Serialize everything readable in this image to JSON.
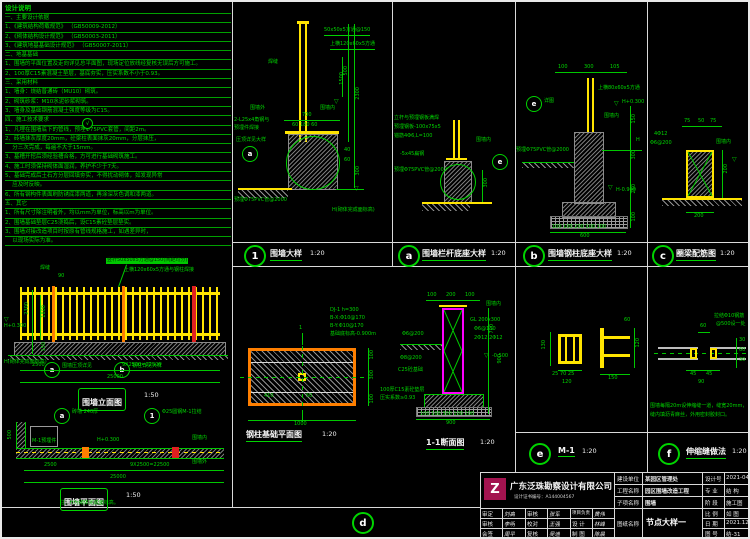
{
  "notes": {
    "title": "设计说明",
    "badge": "√",
    "lines": [
      "一、主要设计依据",
      "1、《建筑结构荷载规范》 （GB50009-2012）",
      "2、《砌体结构设计规范》 （GB50003-2011）",
      "3、《建筑地基基础设计规范》 （GB50007-2011）",
      "二、地基基础",
      "1、围墙的平面位置及走向详见总平面图，现场定位放线经复核无误后方可施工。",
      "2、100厚C15素混凝土垫层，基底夯实，压实系数不小于0.93。",
      "三、采用材料",
      "1、墙身：烧结普通砖（MU10）砌筑。",
      "2、砌筑砂浆：M10水泥砂浆砌筑。",
      "3、墙身及基础钢筋混凝土强度等级为C15。",
      "四、施工技术要求",
      "1、凡埋在围墙底下的管线，预埋Φ75PVC套管，间距2m。",
      "2、砖墙抹灰厚度20mm，砼梁柱表面抹灰20mm，分层抹压，",
      "　 分三次完成，每遍不大于15mm。",
      "3、基槽开挖后须经验槽合格，方可进行基础砌筑施工。",
      "4、施工时须保持砌体面湿润，养护不少于7天。",
      "5、基础完成后土石方分层回填夯实，不得扰动砌体，如发现异常",
      "　 应及时反映。",
      "6、所有钢构件表面刷防锈底漆两道，再涂深灰色调和漆两道。",
      "五、其它",
      "1、所有尺寸除注明者外，均以mm为单位，标高以m为单位。",
      "2、围墙基础垫层C25浇捣后，设C15素砼垫层垫实。",
      "3、围墙对接改造项目时按原有管线规格施工，如遇差异时，",
      "　 以现场实际为准。"
    ]
  },
  "elevation": {
    "title": "围墙立面图",
    "scale": "1:50",
    "ann_highlight": "竖杆50x50x5方通@150(间距均分)",
    "ann2": "上横120x60x5方通与钢柱焊接",
    "weld": "焊缝",
    "angle": "90",
    "lvl_top": "H+0.300",
    "lvl_bottom": "H(砌体完成面标高)",
    "dim_v_total": "2300",
    "dim_v_rail": "1800",
    "dim_v_base": "150",
    "dim_seg": "2500",
    "dim_mid": "9X2500=22500",
    "dim_total": "25000",
    "mk1": "a",
    "mk1_label": "围墙压顶详见",
    "mk2": "b",
    "mk2_label": "钢柱详见大样"
  },
  "plan": {
    "title": "围墙平面图",
    "scale": "1:50",
    "note": "注：H为砌体完成面标高。",
    "mk1": "a",
    "mk1_label": "砖墙 240厚",
    "mk2": "1",
    "mk2_label": "Φ25圆钢M-1拉结",
    "tag": "M-1预埋件",
    "lvl": "H+0.300",
    "side_in": "围墙内",
    "side_out": "围墙外",
    "dim_left": "500",
    "dim_seg": "2500",
    "dim_mid": "9X2500=22500",
    "dim_total": "25000"
  },
  "d1": {
    "mark": "1",
    "title": "围墙大样",
    "scale": "1:20",
    "ann1": "50x50x5方通@150",
    "ann2": "上横120x60x5方通",
    "weld": "焊缝",
    "anchor1": "2-L25x4角钢与",
    "anchor2": "预埋件焊接",
    "pvc": "预埋Φ75PVC管@2000",
    "side_out": "围墙外",
    "side_in": "围墙内",
    "mk": "a",
    "mk_label": "压顶详见大样",
    "d500": "500",
    "d2300": "2300",
    "d1500": "1500",
    "d40": "40",
    "d60": "60",
    "d300": "300",
    "d700": "700",
    "dsub": "60 180 60",
    "lvl": "H(砌体完成面标高)"
  },
  "da": {
    "mark": "a",
    "title": "围墙栏杆底座大样",
    "scale": "1:20",
    "l1": "立杆与预埋钢板满焊",
    "l2": "预埋钢板-100x75x5",
    "l3": "锚筋4Φ6,L=100",
    "l4": "-5x45扁钢",
    "pvc": "预埋Φ75PVC管@2000",
    "side_in": "围墙内",
    "mk": "e",
    "d300": "300"
  },
  "db": {
    "mark": "b",
    "title": "围墙钢柱底座大样",
    "scale": "1:20",
    "dt1": "100",
    "dt2": "300",
    "dt3": "105",
    "tube": "上横80x60x5方通",
    "side_in": "围墙内",
    "mk": "e",
    "mk_label": "详图",
    "pvc": "预埋Φ75PVC管@2000",
    "lvl1": "H+0.300",
    "lvl2": "H",
    "lvl3": "H-0.900",
    "dv1": "150",
    "dv2": "300",
    "dv3": "250",
    "dv4": "100",
    "db1": "100 100 200 100 100",
    "db2": "600"
  },
  "dc": {
    "mark": "c",
    "title": "圈梁配筋图",
    "scale": "1:20",
    "dt1": "75",
    "dt2": "50",
    "dt3": "75",
    "l1": "4Φ12",
    "l2": "Φ6@200",
    "side_in": "围墙内",
    "db": "200",
    "dr": "200"
  },
  "dd": {
    "mark": "d",
    "plan_title": "钢柱基础平面图",
    "plan_scale": "1:20",
    "cut": "1",
    "n1": "DJ-1  h=300",
    "n2": "B-X:Φ10@170",
    "n3": "B-Y:Φ10@170",
    "n4": "基础底标高-0.900m",
    "pd1": "410",
    "pd2": "50",
    "pd3": "1000",
    "pv1": "100",
    "pv2": "300",
    "pv3": "100",
    "sec_title": "1-1断面图",
    "sec_scale": "1:20",
    "st1": "100",
    "st2": "200",
    "st3": "100",
    "side_in": "围墙内",
    "s1": "GL 200x300",
    "s2": "Φ6@150",
    "s3": "2Φ12,2Φ12",
    "s4": "Φ6@200",
    "s5": "Φ8@200",
    "s6": "C25砼基础",
    "s7": "100厚C15素砼垫层",
    "s8": "压实系数≥0.93",
    "lvl": "-0.500",
    "sv1": "700",
    "sv2": "900",
    "sb1": "100 100 300 100 100",
    "sb2": "900"
  },
  "de": {
    "mark": "e",
    "title": "M-1",
    "scale": "1:20",
    "dv": "130",
    "db1": "25 70 25",
    "db2": "120",
    "dv2": "120",
    "db3": "150",
    "d60": "60"
  },
  "df": {
    "mark": "f",
    "title": "伸缩缝做法",
    "scale": "1:20",
    "d60": "60",
    "dr1": "30",
    "dr2": "60",
    "dr3": "30",
    "db1": "45",
    "db2": "45",
    "db3": "90",
    "l1": "拉结Φ10钢筋",
    "l2": "@500设一处",
    "t1": "围墙每隔20m设伸缩缝一道，缝宽20mm，",
    "t2": "缝内填沥青麻丝，外用密封胶封口。"
  },
  "titleblock": {
    "company": "广东泛珠勘察设计有限公司",
    "company_sub": "设计证书编号：A144004567",
    "logo_letter": "Z",
    "rows_top": [
      [
        "建设单位",
        "某园区管理处"
      ],
      [
        "工程名称",
        "园区围墙改造工程"
      ],
      [
        "子项名称",
        "围墙"
      ]
    ],
    "rows_right_top": [
      [
        "设计号",
        "2021-046"
      ],
      [
        "专 业",
        "结 构"
      ],
      [
        "阶 段",
        "施工图"
      ]
    ],
    "sheet_label": "图纸名称",
    "sheet_name": "节点大样一",
    "rows_right_bottom": [
      [
        "比 例",
        "如 图"
      ],
      [
        "日 期",
        "2021.12"
      ],
      [
        "图 号",
        "结-31"
      ]
    ],
    "signs": [
      [
        "审定",
        "刘高",
        "审核",
        "张军",
        "项目负责",
        "黄伟"
      ],
      [
        "审核",
        "李明",
        "校对",
        "王强",
        "设 计",
        "林峰"
      ],
      [
        "会签",
        "周平",
        "复核",
        "吴迪",
        "制 图",
        "陈晨"
      ]
    ]
  }
}
